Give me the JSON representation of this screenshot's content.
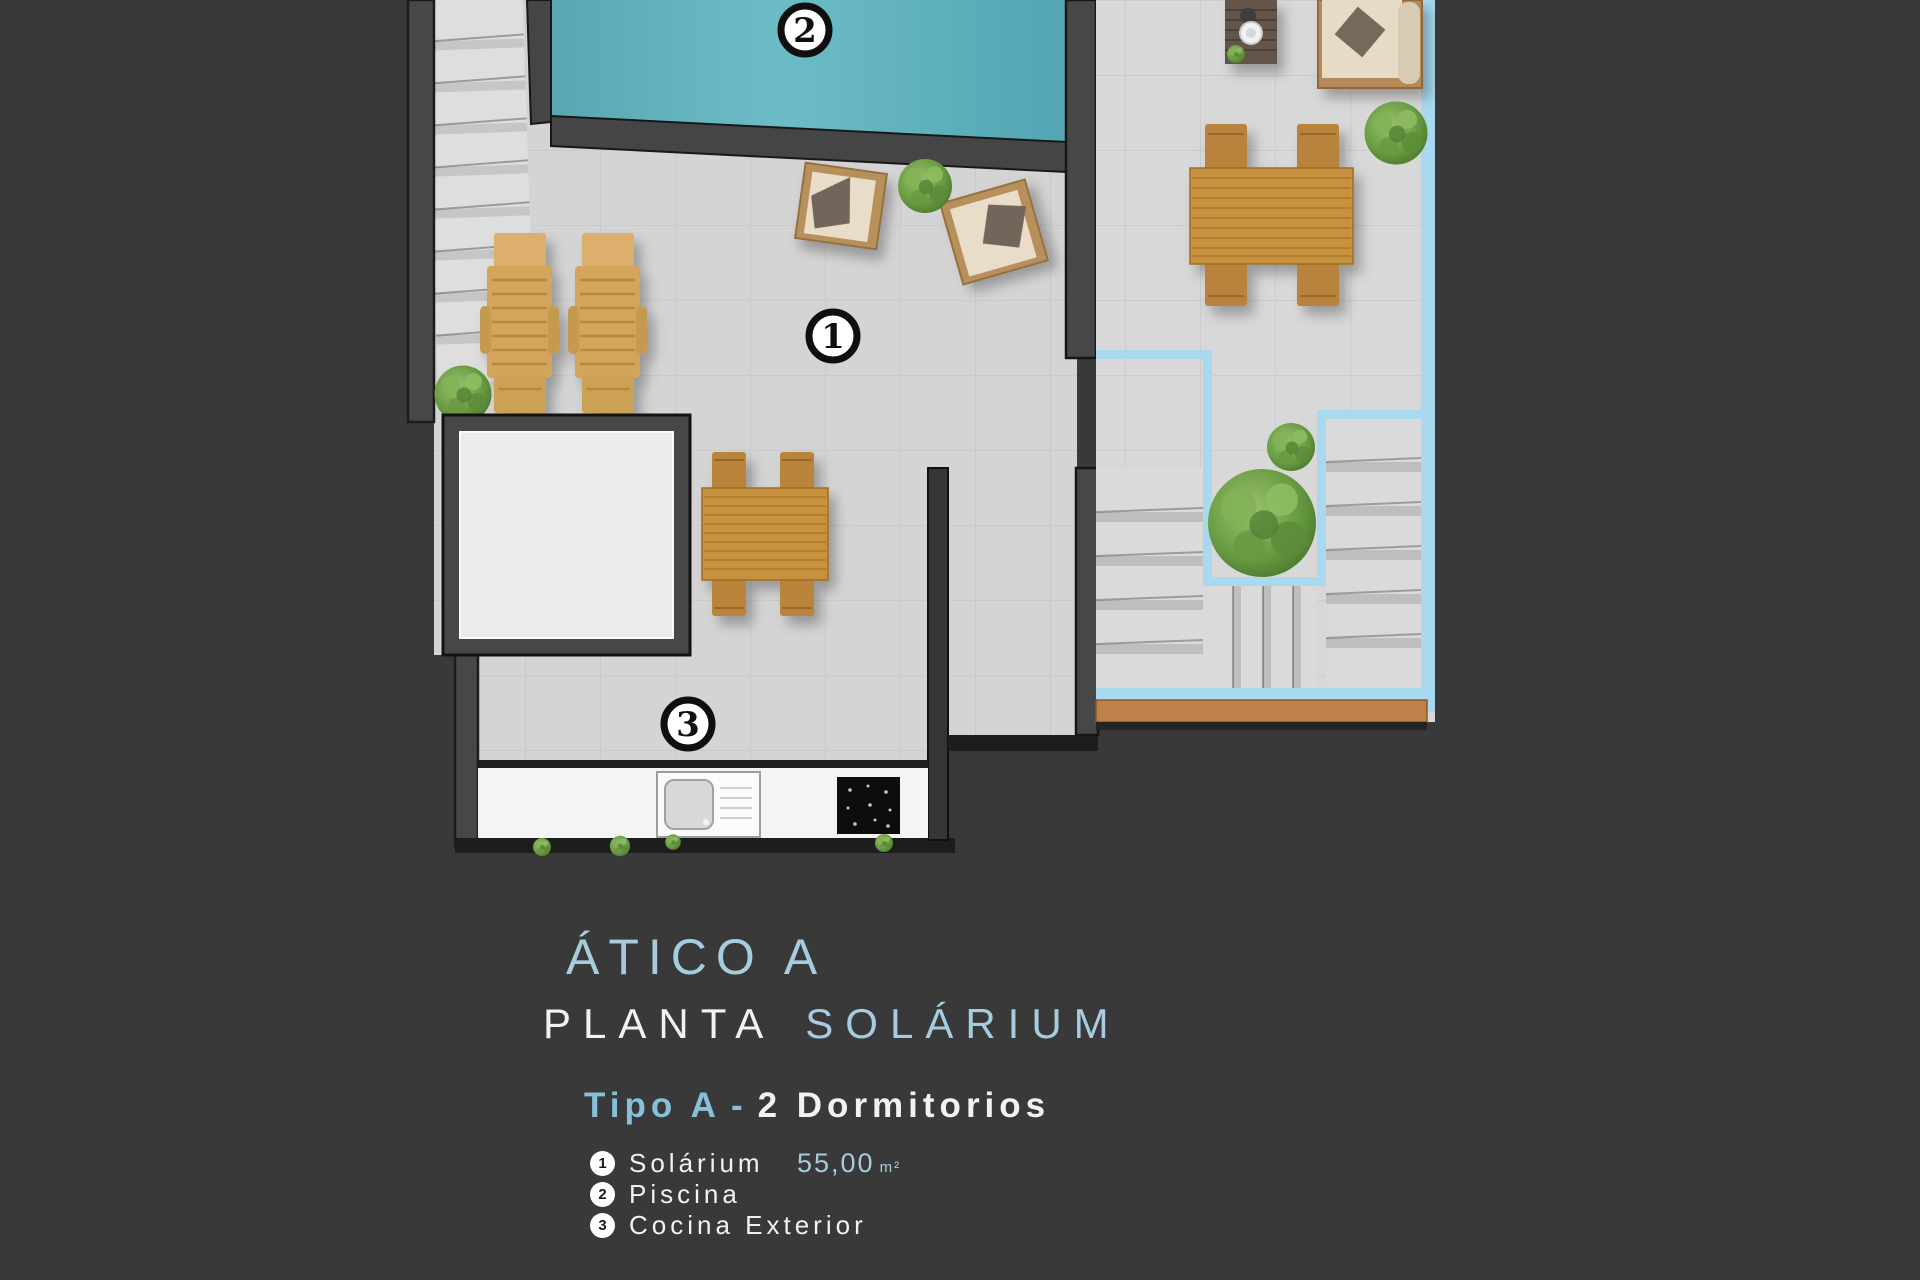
{
  "page": {
    "background": "#3a3939"
  },
  "title": {
    "line1": "ÁTICO A",
    "line2_part1": "PLANTA",
    "line2_part2": "SOLÁRIUM"
  },
  "subtitle": {
    "highlight": "Tipo A",
    "separator": "-",
    "rest": "2 Dormitorios"
  },
  "legend": [
    {
      "number": "1",
      "label": "Solárium",
      "value": "55,00",
      "unit": "m²"
    },
    {
      "number": "2",
      "label": "Piscina",
      "value": "",
      "unit": ""
    },
    {
      "number": "3",
      "label": "Cocina Exterior",
      "value": "",
      "unit": ""
    }
  ],
  "plan": {
    "markers": [
      {
        "area": "solarium",
        "number": "1"
      },
      {
        "area": "piscina",
        "number": "2"
      },
      {
        "area": "cocina-exterior",
        "number": "3"
      }
    ],
    "colors": {
      "background": "#3a3939",
      "wall": "#474747",
      "floor": "#d4d4d4",
      "pool": "#5fb0bd",
      "terrace_outline_blue": "#a9d9ef",
      "wood": "#c7913e",
      "wood_edge_strip": "#bf8147",
      "accent_text": "#a5cddf"
    }
  }
}
